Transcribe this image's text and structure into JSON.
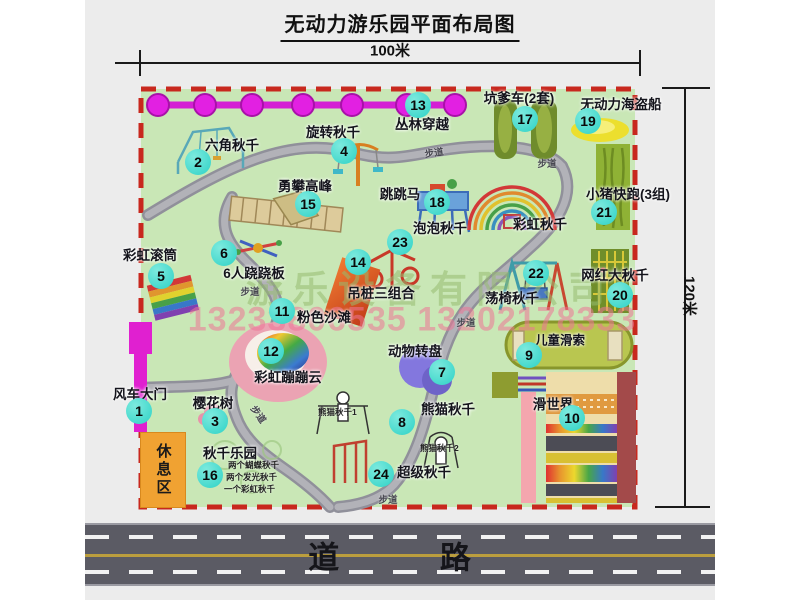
{
  "title": "无动力游乐园平面布局图",
  "dimensions": {
    "width_label": "100米",
    "height_label": "120米"
  },
  "road": {
    "label": "道 路"
  },
  "path_label": "步道",
  "watermark": {
    "line1": "游乐设备有限公司",
    "line2": "13233806535 13202178333"
  },
  "rest_area_label": "休息区",
  "rainbow_swing_label": "彩虹秋千",
  "panda_note1": "熊猫秋千1",
  "panda_note2": "熊猫秋千2",
  "swing_park_notes": {
    "n1": "两个蝴蝶秋千",
    "n2": "两个发光秋千",
    "n3": "一个彩虹秋千"
  },
  "attractions": [
    {
      "num": "1",
      "label": "风车大门"
    },
    {
      "num": "2",
      "label": "六角秋千"
    },
    {
      "num": "3",
      "label": "樱花树"
    },
    {
      "num": "4",
      "label": "旋转秋千"
    },
    {
      "num": "5",
      "label": "彩虹滚筒"
    },
    {
      "num": "6",
      "label": "6人跷跷板"
    },
    {
      "num": "7",
      "label": "动物转盘"
    },
    {
      "num": "8",
      "label": "熊猫秋千"
    },
    {
      "num": "9",
      "label": "儿童滑索"
    },
    {
      "num": "10",
      "label": "滑世界"
    },
    {
      "num": "11",
      "label": "粉色沙滩"
    },
    {
      "num": "12",
      "label": "彩虹蹦蹦云"
    },
    {
      "num": "13",
      "label": "丛林穿越"
    },
    {
      "num": "14",
      "label": "吊桩三组合"
    },
    {
      "num": "15",
      "label": "勇攀高峰"
    },
    {
      "num": "16",
      "label": "秋千乐园"
    },
    {
      "num": "17",
      "label": "坑爹车(2套)"
    },
    {
      "num": "18",
      "label": "跳跳马"
    },
    {
      "num": "19",
      "label": "无动力海盗船"
    },
    {
      "num": "20",
      "label": "网红大秋千"
    },
    {
      "num": "21",
      "label": "小猪快跑(3组)"
    },
    {
      "num": "22",
      "label": "荡椅秋千"
    },
    {
      "num": "23",
      "label": "泡泡秋千"
    },
    {
      "num": "24",
      "label": "超级秋千"
    }
  ],
  "colors": {
    "field_green": "#c9e7b6",
    "border_red": "#c8281e",
    "path_gray": "#a9a9af",
    "accent_teal": "#2ed2c6",
    "magenta": "#e220e2",
    "road_gray": "#5b5b64",
    "rest_orange": "#f0a232"
  }
}
